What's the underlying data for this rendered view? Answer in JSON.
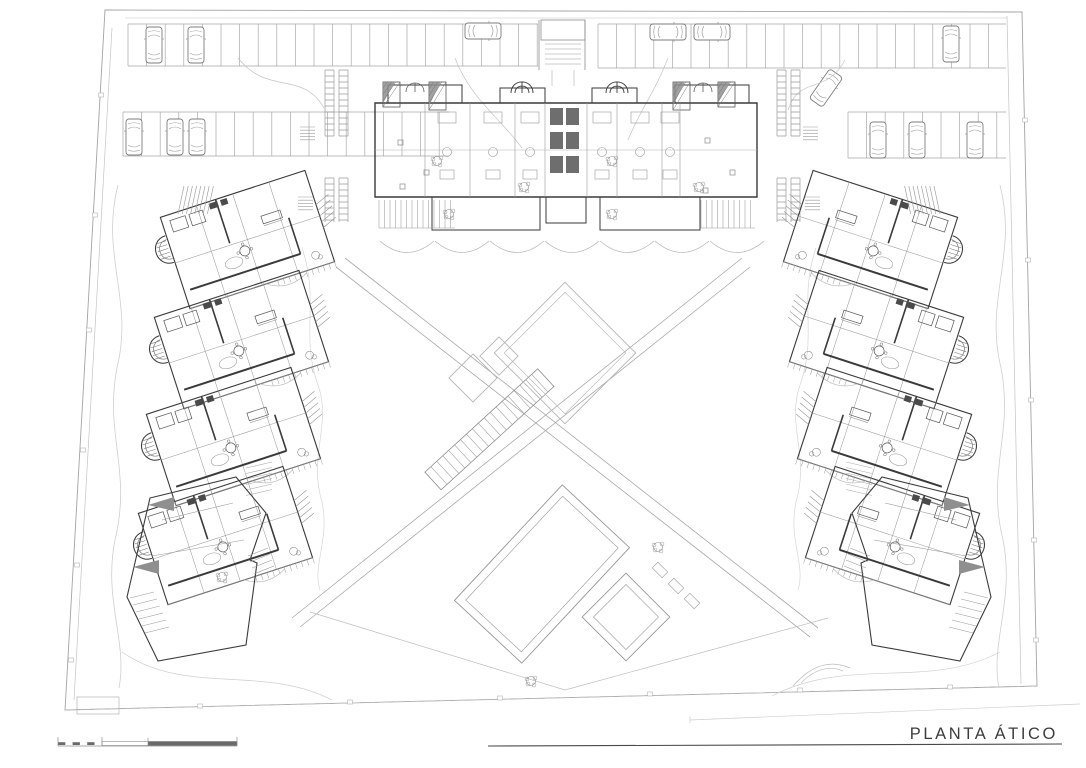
{
  "title_block": {
    "label": "PLANTA ÁTICO"
  },
  "palette": {
    "paper": "#ffffff",
    "ink": "#3a3a3a",
    "medium": "#8d8d8d",
    "light": "#b5b5b5",
    "faint": "#d2d2d2",
    "shade": "#8f8f8f",
    "fill_dark": "#4a4a4a"
  },
  "plan": {
    "cars": [
      {
        "x": 154,
        "y": 45,
        "rot": 0
      },
      {
        "x": 196,
        "y": 45,
        "rot": 0
      },
      {
        "x": 134,
        "y": 137,
        "rot": 0
      },
      {
        "x": 175,
        "y": 137,
        "rot": 0
      },
      {
        "x": 197,
        "y": 137,
        "rot": 0
      },
      {
        "x": 483,
        "y": 31,
        "rot": 90
      },
      {
        "x": 668,
        "y": 32,
        "rot": 90
      },
      {
        "x": 712,
        "y": 32,
        "rot": 90
      },
      {
        "x": 951,
        "y": 44,
        "rot": 0
      },
      {
        "x": 826,
        "y": 88,
        "rot": 35
      },
      {
        "x": 878,
        "y": 140,
        "rot": 0
      },
      {
        "x": 917,
        "y": 140,
        "rot": 0
      },
      {
        "x": 975,
        "y": 140,
        "rot": 0
      }
    ],
    "stall_rows": [
      {
        "x0": 128,
        "x1": 538,
        "y0": 24,
        "y1": 66,
        "step": 18.6
      },
      {
        "x0": 123,
        "x1": 449,
        "y0": 112,
        "y1": 156,
        "step": 18.6
      },
      {
        "x0": 598,
        "x1": 1006,
        "y0": 24,
        "y1": 68,
        "step": 18.6
      },
      {
        "x0": 848,
        "x1": 1006,
        "y0": 112,
        "y1": 158,
        "step": 18.6
      }
    ],
    "ladders": [
      {
        "x": 325,
        "y": 70,
        "h": 66
      },
      {
        "x": 339,
        "y": 70,
        "h": 66
      },
      {
        "x": 325,
        "y": 178,
        "h": 44
      },
      {
        "x": 339,
        "y": 178,
        "h": 44
      },
      {
        "x": 777,
        "y": 70,
        "h": 66
      },
      {
        "x": 791,
        "y": 70,
        "h": 66
      },
      {
        "x": 777,
        "y": 178,
        "h": 44
      },
      {
        "x": 791,
        "y": 178,
        "h": 44
      }
    ],
    "stepcombs": [
      {
        "x": 803,
        "y": 127
      },
      {
        "x": 805,
        "y": 197
      },
      {
        "x": 300,
        "y": 127
      },
      {
        "x": 298,
        "y": 197
      }
    ],
    "pergolas": [
      {
        "x": 383,
        "y": 82,
        "w": 17,
        "h": 25
      },
      {
        "x": 429,
        "y": 82,
        "w": 17,
        "h": 28
      },
      {
        "x": 673,
        "y": 82,
        "w": 17,
        "h": 28
      },
      {
        "x": 718,
        "y": 82,
        "w": 17,
        "h": 25
      }
    ],
    "arches": [
      {
        "cx": 415,
        "cy": 92,
        "r": 9
      },
      {
        "cx": 703,
        "cy": 92,
        "r": 9
      }
    ],
    "building": {
      "dividers": [
        425,
        470,
        515,
        545,
        587,
        617,
        662,
        680
      ],
      "units": [
        447,
        493,
        530,
        602,
        640,
        670
      ],
      "cores": [
        [
          550,
          108
        ],
        [
          550,
          132
        ],
        [
          550,
          156
        ],
        [
          566,
          108
        ],
        [
          566,
          132
        ],
        [
          566,
          156
        ]
      ],
      "combs": [
        {
          "x0": 379,
          "x1": 455,
          "y0": 200,
          "y1": 228,
          "step": 5.5
        },
        {
          "x0": 701,
          "x1": 755,
          "y0": 200,
          "y1": 228,
          "step": 5.5
        }
      ],
      "scallops": [
        407,
        462,
        517,
        572,
        627,
        682,
        737
      ],
      "terrace_squares": [
        [
          398,
          140
        ],
        [
          424,
          170
        ],
        [
          400,
          184
        ],
        [
          705,
          138
        ],
        [
          730,
          170
        ],
        [
          703,
          188
        ]
      ]
    },
    "wings": {
      "module_anchors": [
        [
          169,
          244
        ],
        [
          163,
          344
        ],
        [
          155,
          441
        ],
        [
          147,
          540
        ]
      ],
      "rotation": -18,
      "mirror_offset": 1118,
      "trellis": {
        "x": 184,
        "y": 186,
        "n": 8,
        "dx": 4.2,
        "skew": -6,
        "len": 28
      },
      "steps_comb": {
        "x": 246,
        "y": 468,
        "n": 6,
        "dy": 5.5,
        "w": 26,
        "rise": -6
      }
    },
    "courtyard": {
      "pools": [
        {
          "cx": 565,
          "cy": 353,
          "w": 100,
          "h": 100,
          "rot": 45,
          "inset": 7,
          "tone": "light"
        },
        {
          "cx": 473,
          "cy": 378,
          "w": 34,
          "h": 34,
          "rot": 45,
          "inset": 0,
          "tone": "light"
        },
        {
          "cx": 499,
          "cy": 356,
          "w": 27,
          "h": 27,
          "rot": 45,
          "inset": 0,
          "tone": "light"
        },
        {
          "cx": 542,
          "cy": 574,
          "w": 92,
          "h": 158,
          "rot": 43,
          "inset": 8,
          "tone": "normal"
        },
        {
          "cx": 626,
          "cy": 617,
          "w": 62,
          "h": 62,
          "rot": 45,
          "inset": 8,
          "tone": "normal"
        }
      ],
      "pool_steps": [
        [
          660,
          570
        ],
        [
          676,
          586
        ],
        [
          692,
          601
        ]
      ],
      "stair": {
        "x": 433,
        "y": 481,
        "angle": -42.5,
        "len": 153,
        "width": 24,
        "treads": 18
      }
    },
    "plants": [
      [
        437,
        161
      ],
      [
        524,
        187
      ],
      [
        612,
        161
      ],
      [
        699,
        187
      ],
      [
        449,
        214
      ],
      [
        612,
        214
      ],
      [
        222,
        577
      ],
      [
        531,
        681
      ],
      [
        658,
        547
      ]
    ],
    "boundary_marks": [
      [
        101,
        95
      ],
      [
        95,
        215
      ],
      [
        89,
        330
      ],
      [
        83,
        450
      ],
      [
        77,
        565
      ],
      [
        71,
        660
      ],
      [
        1025,
        120
      ],
      [
        1028,
        260
      ],
      [
        1031,
        400
      ],
      [
        1034,
        540
      ],
      [
        1036,
        640
      ],
      [
        200,
        706
      ],
      [
        350,
        702
      ],
      [
        500,
        698
      ],
      [
        650,
        694
      ],
      [
        800,
        690
      ],
      [
        950,
        687
      ]
    ]
  },
  "scale_bar": {
    "dark_dashes": [
      58,
      72.6,
      87.2
    ],
    "dash_w": 7.3
  }
}
